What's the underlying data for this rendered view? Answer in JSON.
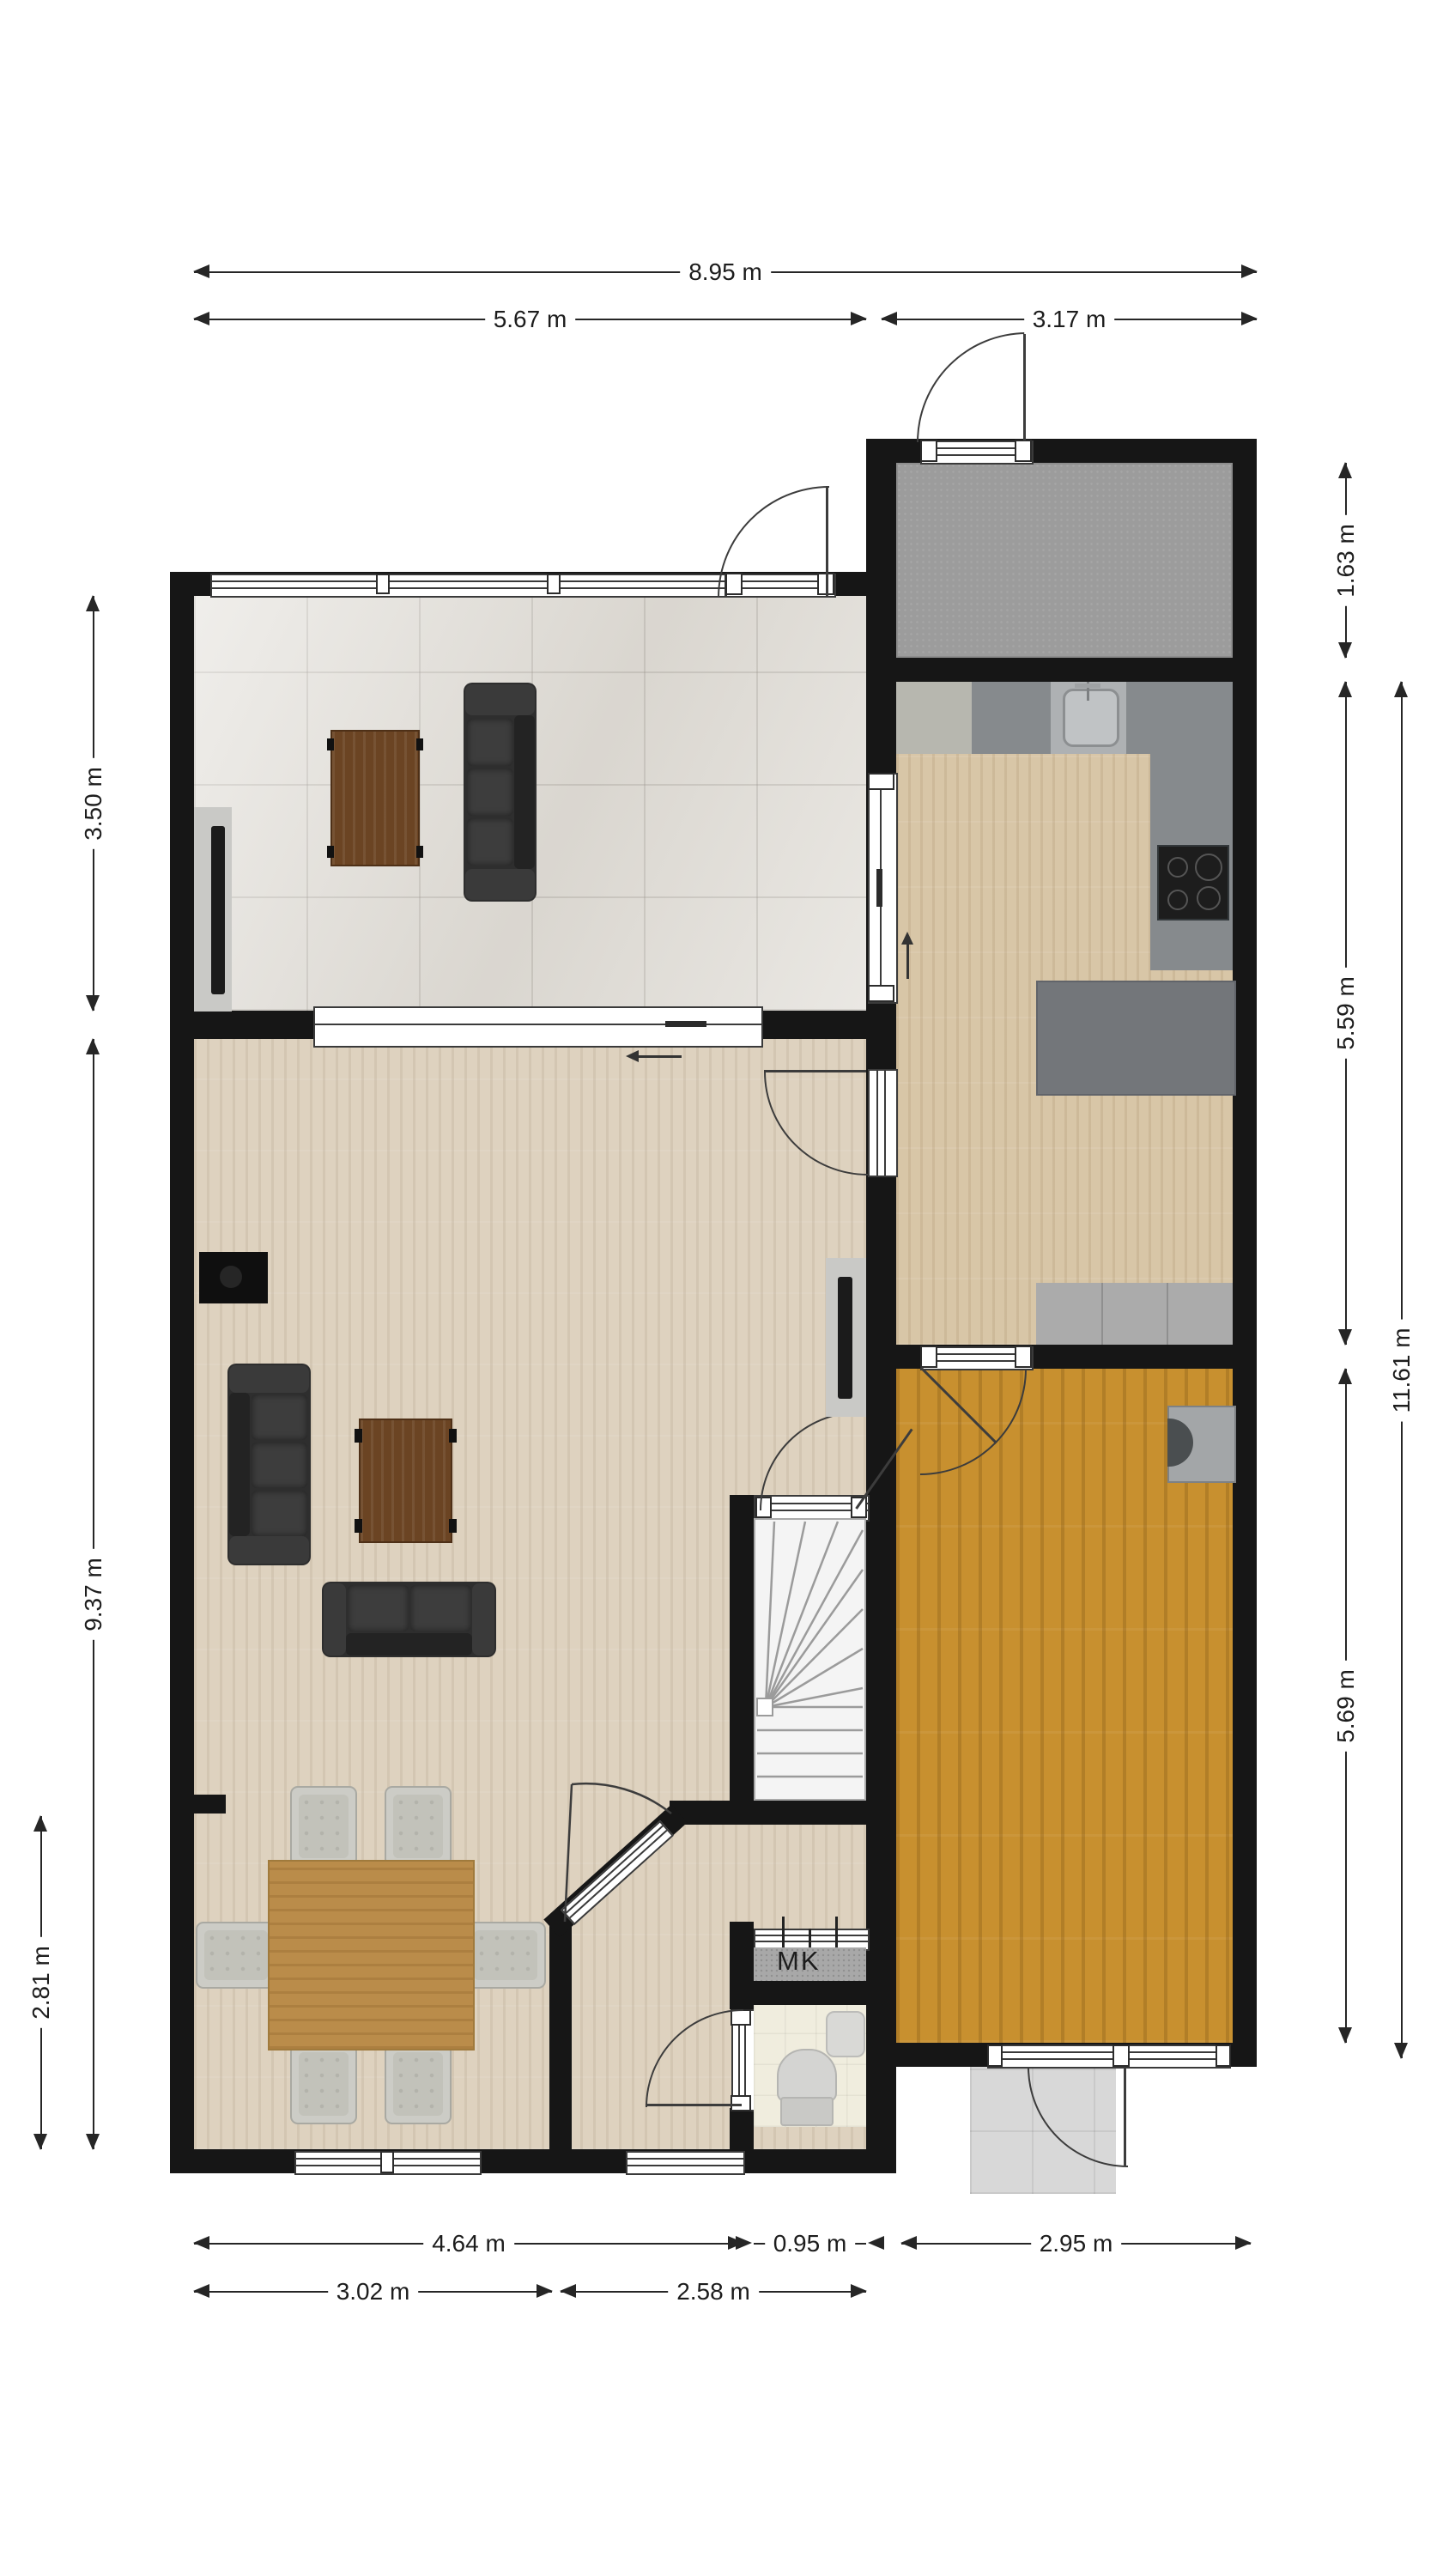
{
  "dimensions": {
    "full_width": "8.95 m",
    "upper_left_width": "5.67 m",
    "upper_right_width": "3.17 m",
    "porch_depth": "1.63 m",
    "kitchen_depth": "5.59 m",
    "right_total_depth": "11.61 m",
    "back_room_depth": "5.69 m",
    "sitting_room_depth": "3.50 m",
    "living_room_depth": "9.37 m",
    "dining_nook_depth": "2.81 m",
    "lower_left_width": "4.64 m",
    "stair_bay_width": "0.95 m",
    "lower_right_width": "2.95 m",
    "dining_width": "3.02 m",
    "hall_width": "2.58 m"
  },
  "labels": {
    "meter_cupboard": "MK"
  },
  "colors": {
    "wall": "#161616",
    "sitting_tile": "#e3e0da",
    "living_wood": "#ded2bf",
    "kitchen_wood": "#d8c6a7",
    "back_room_wood": "#c8902f",
    "porch_concrete": "#9c9c9c",
    "stairs": "#f4f4f4",
    "counter_dark": "#868a8d",
    "counter_light": "#b7b7af",
    "kitchen_island": "#73767a",
    "cooktop": "#1d1d1d",
    "sofa": "#2e2e2e",
    "coffee_table": "#6b4423",
    "dining_table": "#ba8c4a",
    "chair": "#ccccc6",
    "door_mat": "#d8d8d8",
    "toilet_floor": "#f0edde",
    "mk_floor": "#a8a8a8"
  }
}
